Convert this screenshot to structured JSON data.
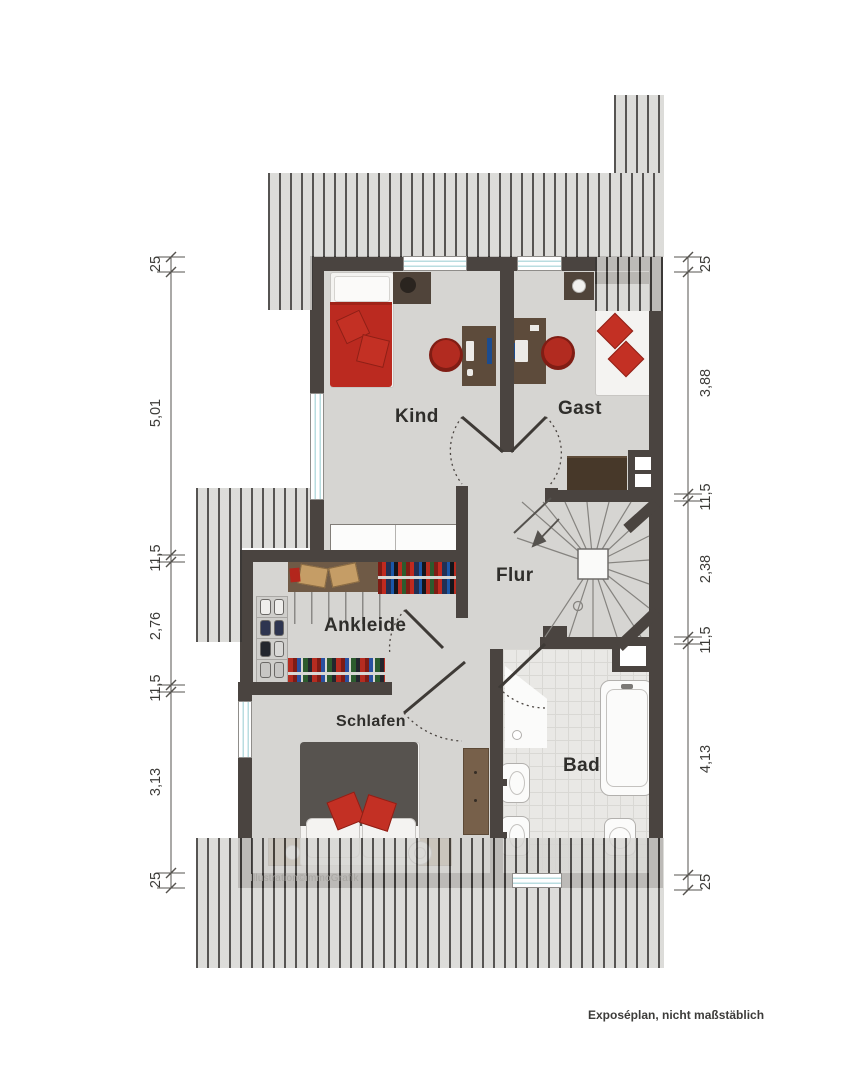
{
  "rooms": [
    {
      "label": "Kind"
    },
    {
      "label": "Gast"
    },
    {
      "label": "Flur"
    },
    {
      "label": "Ankleide"
    },
    {
      "label": "Schlafen"
    },
    {
      "label": "Bad"
    }
  ],
  "dims_left": [
    "25",
    "5,01",
    "11,5",
    "2,76",
    "11,5",
    "3,13",
    "25"
  ],
  "dims_right": [
    "25",
    "3,88",
    "11,5",
    "2,38",
    "11,5",
    "4,13",
    "25"
  ],
  "watermark": "Illustration©immoGrafik",
  "footer_note": "Exposéplan, nicht maßstäblich",
  "colors": {
    "wall": "#4a4440",
    "floor": "#d6d5d2",
    "accent_red": "#c33024",
    "window_glass": "#b9dde0",
    "roof_hatch_stripe": "#383634",
    "wood_dark": "#5d4b3b",
    "wood_light": "#98805f"
  }
}
